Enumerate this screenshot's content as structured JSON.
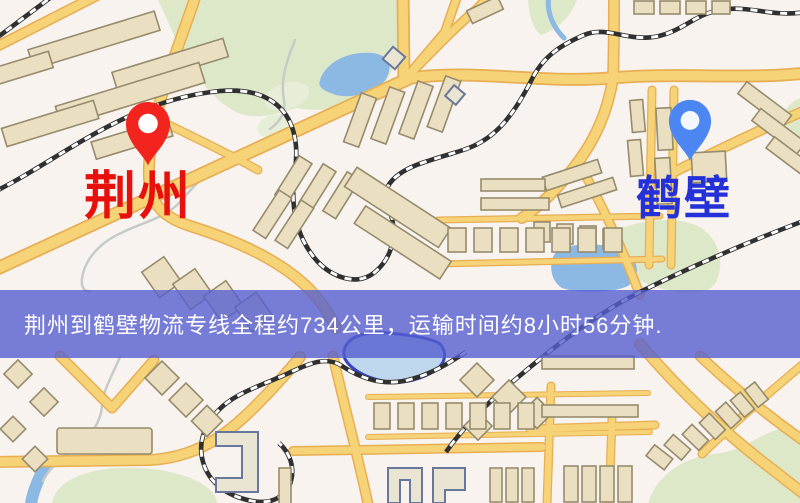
{
  "markers": {
    "origin": {
      "label": "荆州"
    },
    "destination": {
      "label": "鹤壁"
    }
  },
  "banner": {
    "text": "荆州到鹤壁物流专线全程约734公里，运输时间约8小时56分钟."
  },
  "route": {
    "origin": "荆州",
    "destination": "鹤壁",
    "distance_text": "约734公里",
    "duration_text": "约8小时56分钟"
  },
  "icons": {
    "origin_pin": "map-pin-icon",
    "destination_pin": "map-pin-icon"
  },
  "theme": {
    "map_bg": "#f8f3ee",
    "park": "#dde8c8",
    "park_soft": "#e6eed8",
    "water": "#8cb8e4",
    "lake_outline": "#3644c6",
    "stream": "#c6cbc7",
    "road_fill": "#f6d376",
    "road_casing": "#e7ae54",
    "railway": "#303030",
    "railway_tie": "#ffffff",
    "building_fill": "#eadfc0",
    "building_stroke": "#968b6d",
    "building_alt_stroke": "#68779c",
    "banner_bg": "#565fd0",
    "banner_fg": "#ffffff",
    "pin_origin": "#f2241d",
    "pin_origin_hole": "#ffffff",
    "pin_destination": "#4c86f2",
    "pin_destination_hole": "#f3f7ff",
    "label_origin": "#e8100c",
    "label_destination": "#2531d8"
  }
}
